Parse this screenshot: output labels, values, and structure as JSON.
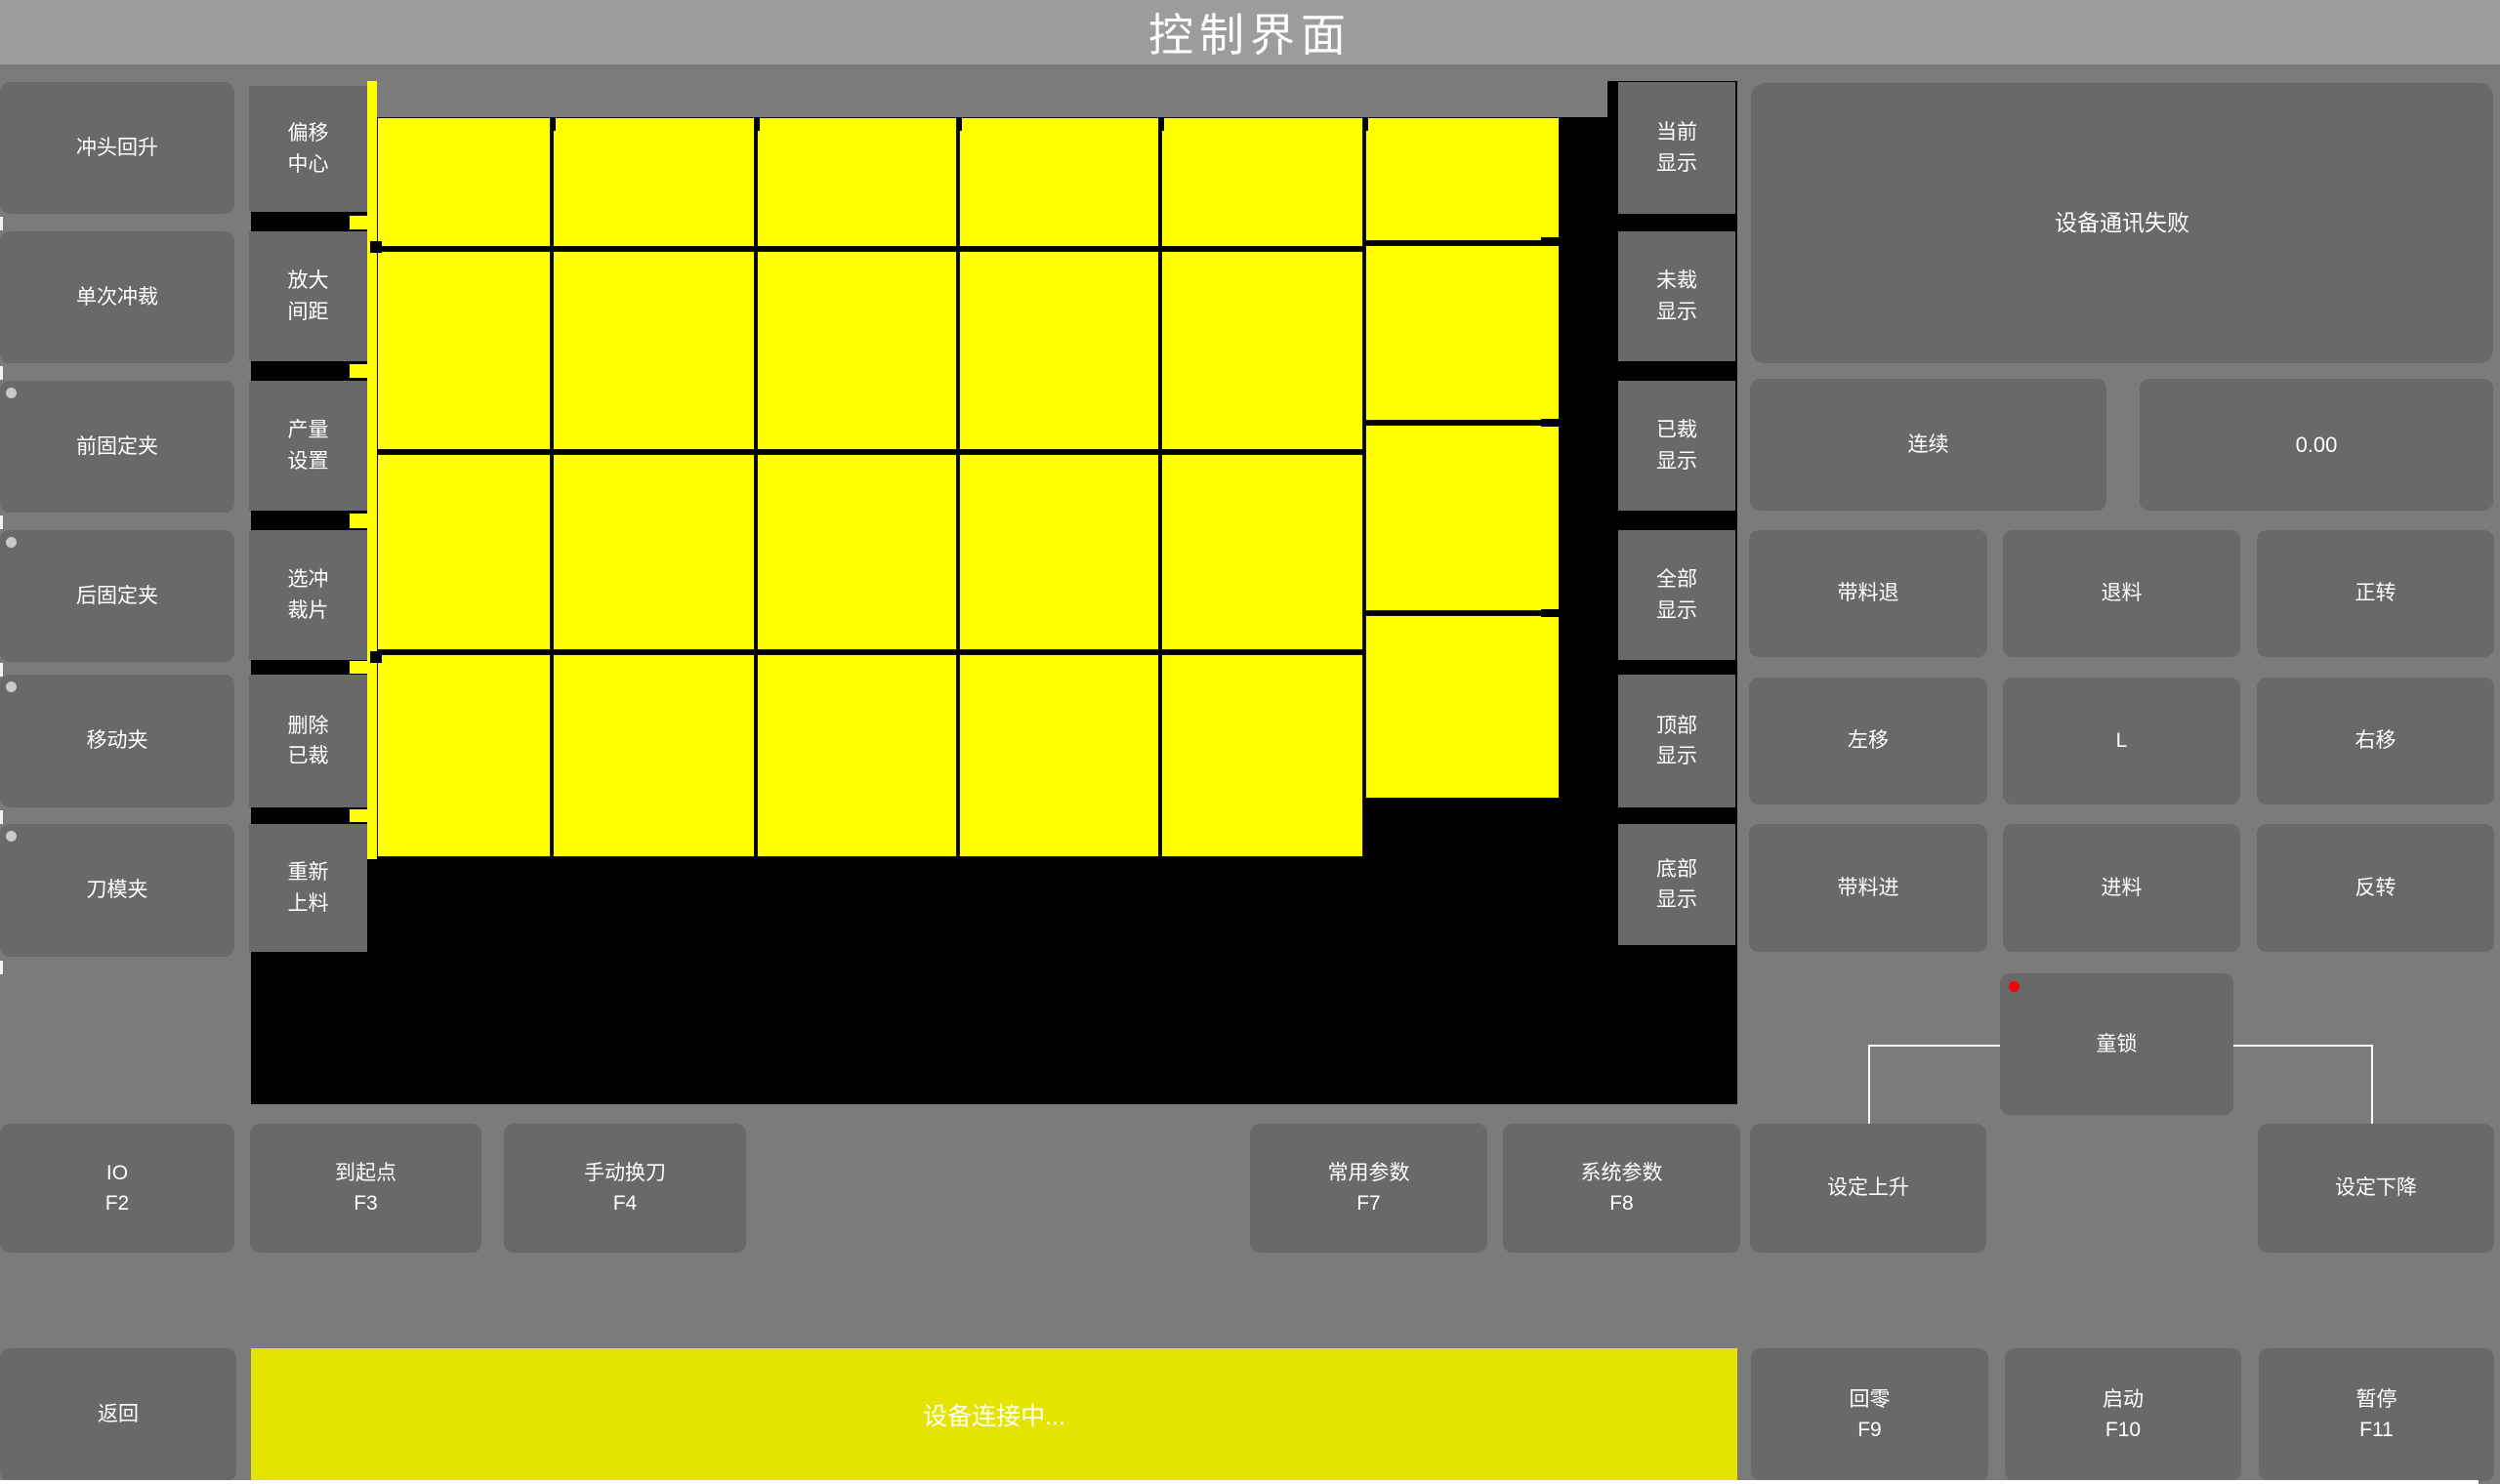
{
  "title_bar": {
    "title": "控制界面"
  },
  "left_column": {
    "buttons": [
      {
        "label": "冲头回升",
        "indicator": false
      },
      {
        "label": "单次冲裁",
        "indicator": false
      },
      {
        "label": "前固定夹",
        "indicator": true
      },
      {
        "label": "后固定夹",
        "indicator": true
      },
      {
        "label": "移动夹",
        "indicator": true
      },
      {
        "label": "刀模夹",
        "indicator": true
      }
    ]
  },
  "tool_column": {
    "buttons": [
      {
        "label": "偏移\n中心"
      },
      {
        "label": "放大\n间距"
      },
      {
        "label": "产量\n设置"
      },
      {
        "label": "选冲\n裁片"
      },
      {
        "label": "删除\n已裁"
      },
      {
        "label": "重新\n上料"
      }
    ]
  },
  "display_column": {
    "buttons": [
      {
        "label": "当前\n显示"
      },
      {
        "label": "未裁\n显示"
      },
      {
        "label": "已裁\n显示"
      },
      {
        "label": "全部\n显示"
      },
      {
        "label": "顶部\n显示"
      },
      {
        "label": "底部\n显示"
      }
    ]
  },
  "right_panel": {
    "status_message": "设备通讯失败",
    "mode_button": "连续",
    "value_display": "0.00",
    "jog_buttons": [
      [
        "带料退",
        "退料",
        "正转"
      ],
      [
        "左移",
        "L",
        "右移"
      ],
      [
        "带料进",
        "进料",
        "反转"
      ]
    ],
    "child_lock_button": "童锁"
  },
  "function_row": {
    "buttons": [
      {
        "label": "IO",
        "fkey": "F2"
      },
      {
        "label": "到起点",
        "fkey": "F3"
      },
      {
        "label": "手动换刀",
        "fkey": "F4"
      },
      {
        "label": "常用参数",
        "fkey": "F7"
      },
      {
        "label": "系统参数",
        "fkey": "F8"
      },
      {
        "label": "设定上升",
        "fkey": ""
      },
      {
        "label": "设定下降",
        "fkey": ""
      }
    ]
  },
  "bottom_bar": {
    "back_button": "返回",
    "status_message": "设备连接中...",
    "buttons": [
      {
        "label": "回零",
        "fkey": "F9"
      },
      {
        "label": "启动",
        "fkey": "F10"
      },
      {
        "label": "暂停",
        "fkey": "F11"
      }
    ]
  },
  "workspace": {
    "description": "sheet cutting layout preview",
    "piece_columns": 6,
    "piece_rows": 4,
    "piece_count": 24
  },
  "colors": {
    "titlebar": "#9c9c9c",
    "page": "#7b7b7b",
    "button": "#696969",
    "canvas": "#000000",
    "sheet": "#ffff00",
    "status_bar": "#e4e400",
    "alert_dot": "#ff0000",
    "indicator_dot": "#c9c9c9",
    "text": "#ffffff"
  }
}
